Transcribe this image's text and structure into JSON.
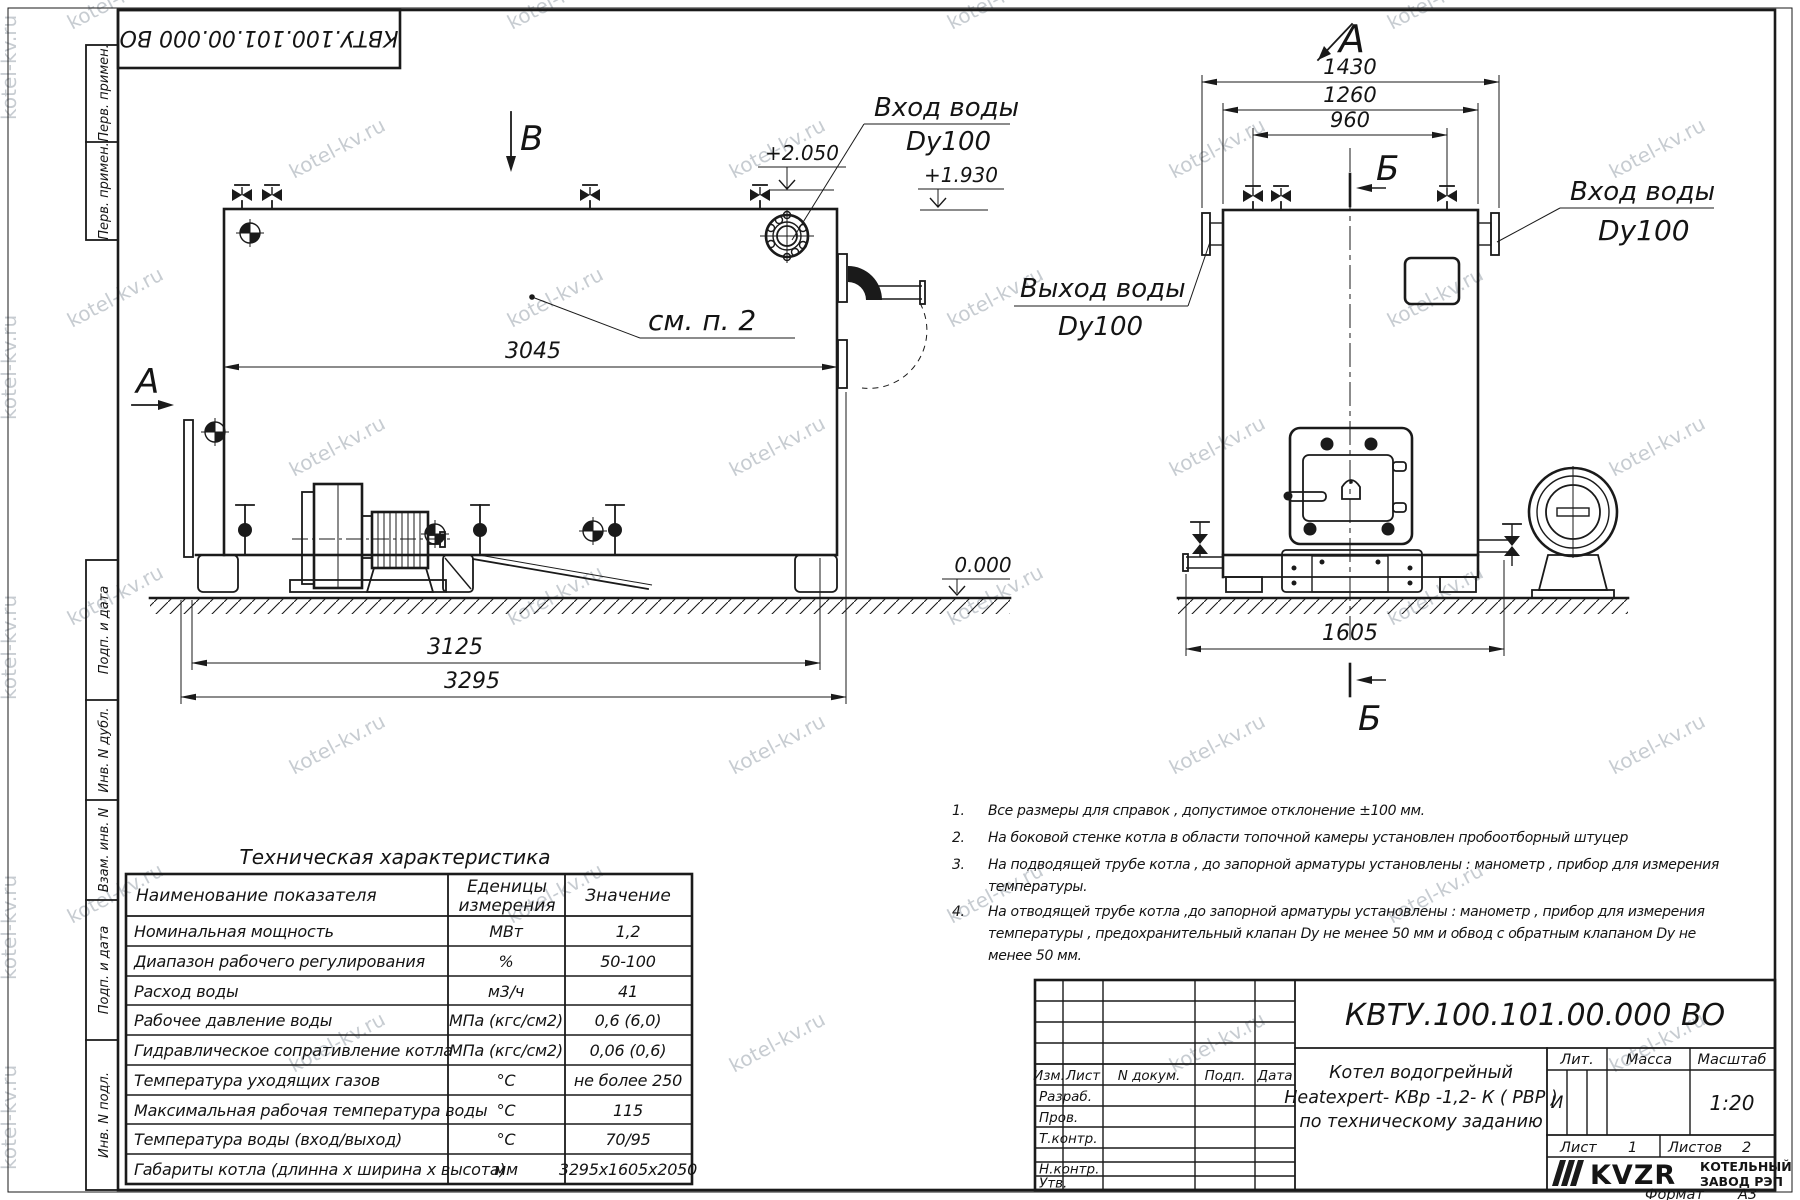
{
  "watermark": {
    "text": "kotel-kv.ru"
  },
  "stamp_top": "КВТУ.100.101.00.000  ВО",
  "margin": {
    "top": [
      "Перв. примен.",
      "Перв. примен."
    ],
    "bottom": [
      "Подп. и дата",
      "Инв. N дубл.",
      "Взам. инв. N",
      "Подп. и дата",
      "Инв. N подл."
    ]
  },
  "side_view": {
    "view_label_b": "В",
    "view_label_a": "А",
    "dim_3045": "3045",
    "dim_3125": "3125",
    "dim_3295": "3295",
    "elev_top": "+2.050",
    "elev_outlet": "+1.930",
    "elev_zero": "0.000",
    "inlet_label": "Вход воды",
    "inlet_dn": "Dy100",
    "see_note": "см. п. 2"
  },
  "front_view": {
    "view_label_a": "А",
    "section_label_top": "Б",
    "section_label_bottom": "Б",
    "dim_1430": "1430",
    "dim_1260": "1260",
    "dim_960": "960",
    "dim_1605": "1605",
    "outlet_label": "Выход воды",
    "outlet_dn": "Dy100",
    "inlet_label": "Вход воды",
    "inlet_dn": "Dy100"
  },
  "notes": {
    "n1": {
      "num": "1.",
      "l1": "Все размеры для справок , допустимое отклонение  ±100 мм."
    },
    "n2": {
      "num": "2.",
      "l1": "На боковой стенке котла в области топочной камеры установлен пробоотборный штуцер"
    },
    "n3": {
      "num": "3.",
      "l1": "На   подводящей трубе котла , до запорной арматуры установлены :  манометр ,  прибор для измерения",
      "l2": "температуры."
    },
    "n4": {
      "num": "4.",
      "l1": "На отводящей трубе котла ,до запорной арматуры установлены :  манометр ,  прибор для измерения",
      "l2": "температуры ,  предохранительный клапан  Dу не менее  50 мм и обвод с обратным клапаном  Dу не",
      "l3": "менее  50 мм."
    }
  },
  "tech_table": {
    "title": "Техническая характеристика",
    "header_name": "Наименование показателя",
    "header_unit_1": "Еденицы",
    "header_unit_2": "измерения",
    "header_value": "Значение",
    "rows": [
      {
        "name": "Номинальная мощность",
        "unit": "МВт",
        "value": "1,2"
      },
      {
        "name": "Диапазон рабочего регулирования",
        "unit": "%",
        "value": "50-100"
      },
      {
        "name": "Расход воды",
        "unit": "м3/ч",
        "value": "41"
      },
      {
        "name": "Рабочее давление воды",
        "unit": "МПа (кгс/см2)",
        "value": "0,6 (6,0)"
      },
      {
        "name": "Гидравлическое сопративление котла",
        "unit": "МПа (кгс/см2)",
        "value": "0,06 (0,6)"
      },
      {
        "name": "Температура уходящих газов",
        "unit": "°С",
        "value": "не более 250"
      },
      {
        "name": "Максимальная рабочая температура воды",
        "unit": "°С",
        "value": "115"
      },
      {
        "name": "Температура воды (вход/выход)",
        "unit": "°С",
        "value": "70/95"
      },
      {
        "name": "Габариты котла (длинна х ширина х высота)",
        "unit": "мм",
        "value": "3295х1605х2050"
      }
    ]
  },
  "title_block": {
    "designation": "КВТУ.100.101.00.000  ВО",
    "name_line_1": "Котел водогрейный",
    "name_line_2": "Heatexpert- КВр -1,2- К ( РВР )",
    "name_line_3": "по техническому заданию",
    "col_izm": "Изм.",
    "col_list": "Лист",
    "col_ndoc": "N докум.",
    "col_podp": "Подп.",
    "col_data": "Дата",
    "row_razrab": "Разраб.",
    "row_prov": "Пров.",
    "row_tkontr": "Т.контр.",
    "row_nkontr": "Н.контр.",
    "row_utv": "Утв.",
    "lit_label": "Лит.",
    "mass_label": "Масса",
    "scale_label": "Масштаб",
    "lit_value": "И",
    "scale_value": "1:20",
    "sheet_label": "Лист",
    "sheet_value": "1",
    "sheets_label": "Листов",
    "sheets_value": "2",
    "logo_text": "KVZR",
    "org_line_1": "КОТЕЛЬНЫЙ",
    "org_line_2": "ЗАВОД РЭП",
    "format_label": "Формат",
    "format_value": "А3"
  }
}
